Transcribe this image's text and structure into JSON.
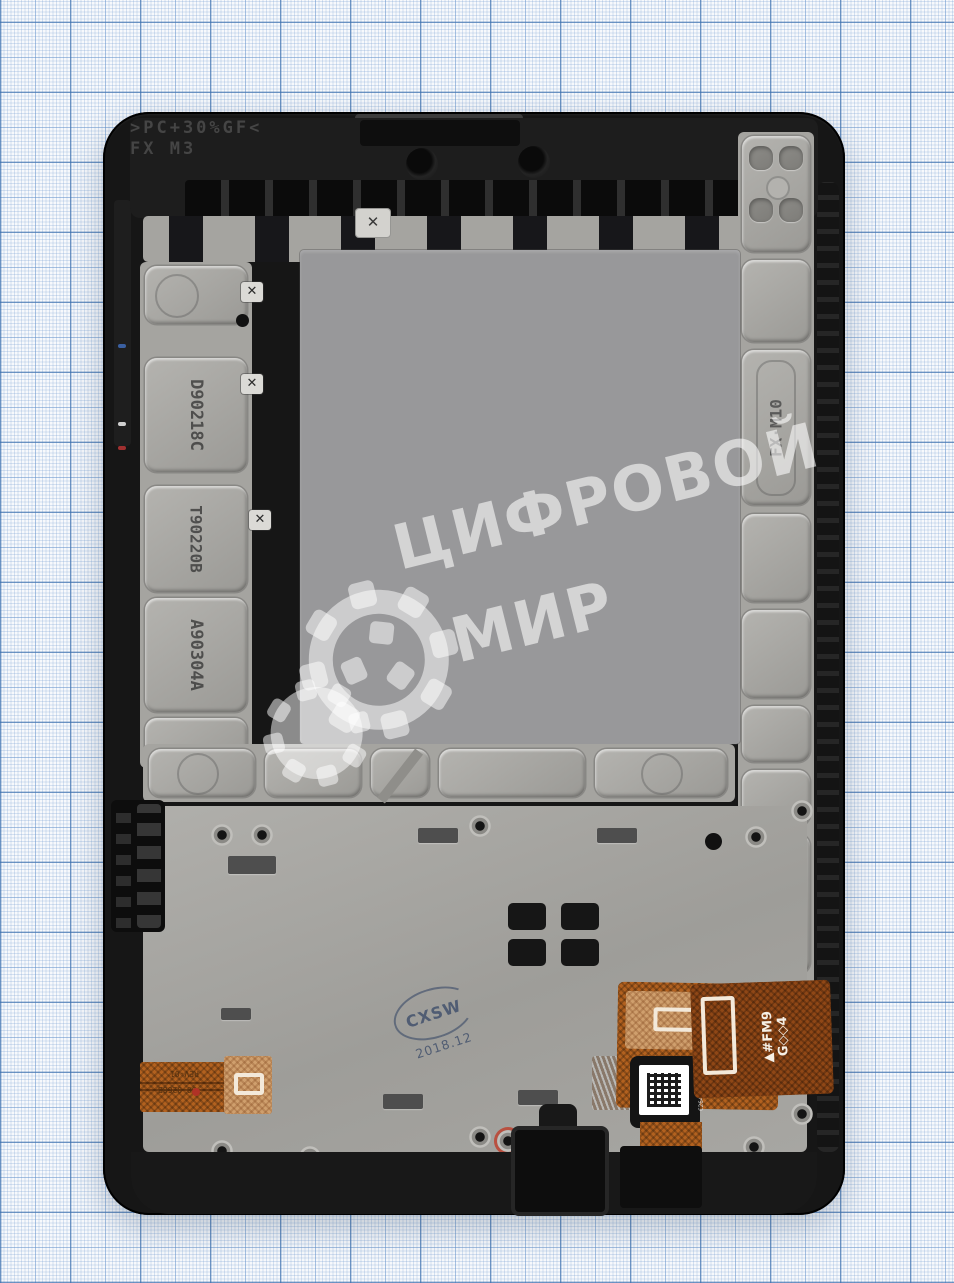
{
  "watermark": {
    "line1": "ЦИФРОВОЙ",
    "line2": "МИР",
    "color": "#ffffff"
  },
  "markings": {
    "top_material_line1": ">PC+30%GF<",
    "top_material_line2": "FX  M3",
    "left_codes": [
      "D90218C",
      "T90220B",
      "A90304A"
    ],
    "right_mold_code": "FX·M10",
    "right_part_code": "MGE-25",
    "clip_mark": "✕",
    "screw_mark": "✕"
  },
  "qc_stamp": {
    "text": "CXSW",
    "date": "2018.12"
  },
  "flex_left": {
    "line1": "90-0268B",
    "line2": "REV-01"
  },
  "flex_right": {
    "line1": "▲#FM9",
    "line2": "G◇◇4",
    "micro_text": "C264 6D3 04C1"
  },
  "colors": {
    "paper_grid": "#6f94bd",
    "frame_black": "#161616",
    "metal_gray": "#a6a5a1",
    "plate_gray": "#98989a",
    "flex_orange": "#b2611f",
    "stamp_blue": "#3d4f6e",
    "watermark_white": "#ffffff"
  }
}
